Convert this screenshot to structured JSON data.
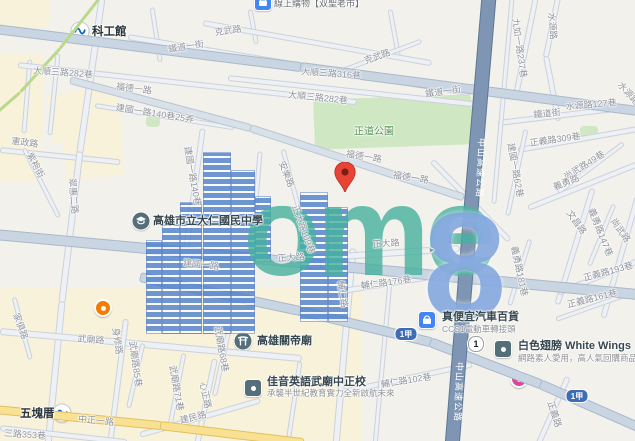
{
  "map": {
    "watermark": {
      "word": "ome",
      "digit": "8"
    },
    "labels": [
      {
        "t": "克武路",
        "x": 228,
        "y": 30,
        "r": -8
      },
      {
        "t": "克武路",
        "x": 377,
        "y": 56,
        "r": -20
      },
      {
        "t": "鐵道一街",
        "x": 186,
        "y": 46,
        "r": -9
      },
      {
        "t": "鐵道一街",
        "x": 443,
        "y": 91,
        "r": -8
      },
      {
        "t": "大順三路316巷",
        "x": 331,
        "y": 73,
        "r": 4
      },
      {
        "t": "大順三路282巷",
        "x": 63,
        "y": 72,
        "r": 4
      },
      {
        "t": "大順三路282巷",
        "x": 318,
        "y": 97,
        "r": 6
      },
      {
        "t": "福德一路",
        "x": 134,
        "y": 88,
        "r": 7
      },
      {
        "t": "福德一路",
        "x": 364,
        "y": 156,
        "r": 9
      },
      {
        "t": "福德一路",
        "x": 411,
        "y": 177,
        "r": 9
      },
      {
        "t": "九如一路237巷",
        "x": 520,
        "y": 48,
        "r": 82
      },
      {
        "t": "水源路",
        "x": 553,
        "y": 26,
        "r": 85
      },
      {
        "t": "水源路",
        "x": 629,
        "y": 93,
        "r": 48
      },
      {
        "t": "水源路127巷",
        "x": 591,
        "y": 104,
        "r": -5
      },
      {
        "t": "鐵道街",
        "x": 547,
        "y": 113,
        "r": -6
      },
      {
        "t": "正道公園",
        "x": 374,
        "y": 130,
        "r": 0,
        "c": "park-t"
      },
      {
        "t": "憲政路",
        "x": 25,
        "y": 142,
        "r": 7
      },
      {
        "t": "紫袍街",
        "x": 36,
        "y": 165,
        "r": 62
      },
      {
        "t": "建國一路140巷25弄",
        "x": 155,
        "y": 113,
        "r": 9
      },
      {
        "t": "建國一路140巷",
        "x": 193,
        "y": 176,
        "r": 80
      },
      {
        "t": "翠惠二路",
        "x": 74,
        "y": 196,
        "r": 85
      },
      {
        "t": "安樂路",
        "x": 287,
        "y": 174,
        "r": 68
      },
      {
        "t": "正大路109巷",
        "x": 304,
        "y": 229,
        "r": 70
      },
      {
        "t": "正大路",
        "x": 386,
        "y": 243,
        "r": -4
      },
      {
        "t": "正大路",
        "x": 291,
        "y": 257,
        "r": -4
      },
      {
        "t": "輔仁路176巷",
        "x": 386,
        "y": 282,
        "r": -8
      },
      {
        "t": "輔仁路",
        "x": 343,
        "y": 294,
        "r": 80
      },
      {
        "t": "建國一路62巷",
        "x": 516,
        "y": 170,
        "r": 80
      },
      {
        "t": "建國一路",
        "x": 201,
        "y": 264,
        "r": 6
      },
      {
        "t": "正義路309巷",
        "x": 555,
        "y": 139,
        "r": -8
      },
      {
        "t": "尚武路49巷",
        "x": 584,
        "y": 165,
        "r": -32
      },
      {
        "t": "義勇路",
        "x": 566,
        "y": 182,
        "r": -22
      },
      {
        "t": "文昌路",
        "x": 577,
        "y": 222,
        "r": 55
      },
      {
        "t": "義勇路147巷",
        "x": 601,
        "y": 232,
        "r": 68
      },
      {
        "t": "尚武路",
        "x": 621,
        "y": 230,
        "r": 55
      },
      {
        "t": "正義路193巷",
        "x": 608,
        "y": 271,
        "r": -15
      },
      {
        "t": "正義路161巷",
        "x": 592,
        "y": 298,
        "r": -14
      },
      {
        "t": "義勇路181巷",
        "x": 520,
        "y": 271,
        "r": 78
      },
      {
        "t": "中山高速公路",
        "x": 481,
        "y": 168,
        "r": 92,
        "c": "hwy-t"
      },
      {
        "t": "中山高速公路",
        "x": 459,
        "y": 392,
        "r": 92,
        "c": "hwy-t"
      },
      {
        "t": "輔仁路102巷",
        "x": 406,
        "y": 380,
        "r": -9
      },
      {
        "t": "武廟路",
        "x": 91,
        "y": 339,
        "r": 4
      },
      {
        "t": "武廟路68巷",
        "x": 222,
        "y": 349,
        "r": 80
      },
      {
        "t": "武廟路85巷",
        "x": 136,
        "y": 364,
        "r": 82
      },
      {
        "t": "武廟路71巷",
        "x": 177,
        "y": 388,
        "r": 80
      },
      {
        "t": "心正路",
        "x": 206,
        "y": 395,
        "r": 78
      },
      {
        "t": "建民路",
        "x": 193,
        "y": 417,
        "r": -14
      },
      {
        "t": "身修路",
        "x": 118,
        "y": 341,
        "r": 82
      },
      {
        "t": "家俱路",
        "x": 21,
        "y": 326,
        "r": 70
      },
      {
        "t": "中正一路",
        "x": 96,
        "y": 420,
        "r": 6
      },
      {
        "t": "三路353巷",
        "x": 25,
        "y": 434,
        "r": 4
      },
      {
        "t": "正義路",
        "x": 555,
        "y": 414,
        "r": 72
      },
      {
        "t": "▸",
        "x": 432,
        "y": 250,
        "r": -4
      }
    ],
    "pois": [
      {
        "kind": "mrt",
        "name": "kmrt-station",
        "x": 80,
        "y": 31,
        "label": "科工館",
        "lx": 92,
        "ly": 31,
        "station": true
      },
      {
        "kind": "mrt",
        "name": "kmrt-station",
        "x": 62,
        "y": 413,
        "label": "五塊厝",
        "lx": 20,
        "ly": 413,
        "station": true
      },
      {
        "kind": "blue-sq",
        "name": "shop-top-partial",
        "x": 263,
        "y": 2,
        "label": "線上購物【双聖老市】",
        "lx": 274,
        "ly": 3,
        "small": true
      },
      {
        "kind": "school",
        "name": "school",
        "x": 141,
        "y": 221,
        "label": "高雄市立大仁國民中學",
        "lx": 153,
        "ly": 220
      },
      {
        "kind": "temple",
        "name": "temple",
        "x": 243,
        "y": 341,
        "label": "高雄關帝廟",
        "lx": 257,
        "ly": 340
      },
      {
        "kind": "dark-sq",
        "name": "school-biz",
        "x": 253,
        "y": 388,
        "label": "佳音英語武廟中正校",
        "lx": 267,
        "ly": 381,
        "sub": "承襲半世紀教育實力全新啟航未來",
        "sx": 267,
        "sy": 393
      },
      {
        "kind": "blue-sq",
        "name": "car-store",
        "x": 427,
        "y": 320,
        "label": "真便宜汽車百貨",
        "lx": 442,
        "ly": 316,
        "sub": "CCS1電動車轉接頭",
        "sx": 442,
        "sy": 329
      },
      {
        "kind": "dark-sq",
        "name": "white-wings-store",
        "x": 503,
        "y": 349,
        "label": "白色翅膀 White Wings",
        "lx": 518,
        "ly": 345,
        "sub": "網路素人愛用，高人氣回購商品",
        "sx": 518,
        "sy": 358
      },
      {
        "kind": "dot-orange",
        "name": "poi-dot",
        "x": 103,
        "y": 308,
        "label": ""
      },
      {
        "kind": "dot-pink",
        "name": "poi-dot",
        "x": 519,
        "y": 379,
        "label": ""
      }
    ],
    "shields": [
      {
        "kind": "plum",
        "text": "1",
        "x": 476,
        "y": 344
      },
      {
        "kind": "blue",
        "text": "1甲",
        "x": 406,
        "y": 334
      },
      {
        "kind": "blue",
        "text": "1甲",
        "x": 577,
        "y": 396
      }
    ],
    "pin": {
      "x": 345,
      "y": 197
    }
  }
}
